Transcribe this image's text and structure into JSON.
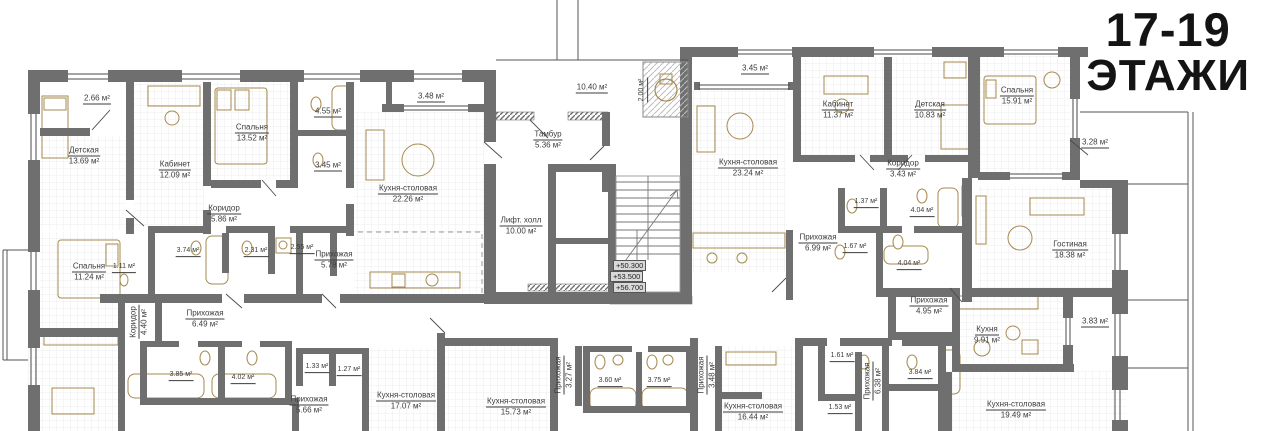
{
  "title": {
    "line1": "17-19",
    "line2": "ЭТАЖИ"
  },
  "colors": {
    "walls": "#6f6f6f",
    "furniture": "#a58a4f",
    "text": "#3c3c3c",
    "title": "#141414"
  },
  "stair_elevations": [
    "+50.300",
    "+53.500",
    "+56.700"
  ],
  "rooms": [
    {
      "name": "",
      "area": "2.66 м²",
      "x": 97,
      "y": 99
    },
    {
      "name": "Детская",
      "area": "13.69 м²",
      "x": 84,
      "y": 156
    },
    {
      "name": "Кабинет",
      "area": "12.09 м²",
      "x": 175,
      "y": 170
    },
    {
      "name": "Спальня",
      "area": "13.52 м²",
      "x": 252,
      "y": 133
    },
    {
      "name": "",
      "area": "4.55 м²",
      "x": 328,
      "y": 112
    },
    {
      "name": "",
      "area": "3.45 м²",
      "x": 328,
      "y": 166
    },
    {
      "name": "",
      "area": "3.48 м²",
      "x": 431,
      "y": 97
    },
    {
      "name": "Кухня-столовая",
      "area": "22.26 м²",
      "x": 408,
      "y": 194
    },
    {
      "name": "Коридор",
      "area": "5.86 м²",
      "x": 224,
      "y": 214
    },
    {
      "name": "",
      "area": "3.74 м²",
      "x": 188,
      "y": 252,
      "small": true
    },
    {
      "name": "",
      "area": "2.31 м²",
      "x": 256,
      "y": 252,
      "small": true
    },
    {
      "name": "",
      "area": "2.55 м²",
      "x": 302,
      "y": 249,
      "small": true
    },
    {
      "name": "Прихожая",
      "area": "5.78 м²",
      "x": 334,
      "y": 260
    },
    {
      "name": "Спальня",
      "area": "11.24 м²",
      "x": 89,
      "y": 272
    },
    {
      "name": "",
      "area": "1.11 м²",
      "x": 124,
      "y": 268,
      "small": true
    },
    {
      "name": "Коридор",
      "area": "4.40 м²",
      "x": 139,
      "y": 322,
      "rot": true
    },
    {
      "name": "Прихожая",
      "area": "6.49 м²",
      "x": 205,
      "y": 319
    },
    {
      "name": "",
      "area": "3.85 м²",
      "x": 181,
      "y": 376,
      "small": true
    },
    {
      "name": "",
      "area": "4.02 м²",
      "x": 243,
      "y": 379,
      "small": true
    },
    {
      "name": "Прихожая",
      "area": "5.66 м²",
      "x": 309,
      "y": 405
    },
    {
      "name": "",
      "area": "1.33 м²",
      "x": 317,
      "y": 368,
      "small": true
    },
    {
      "name": "",
      "area": "1.27 м²",
      "x": 349,
      "y": 371,
      "small": true
    },
    {
      "name": "Кухня-столовая",
      "area": "17.07 м²",
      "x": 406,
      "y": 401
    },
    {
      "name": "Кухня-столовая",
      "area": "15.73 м²",
      "x": 516,
      "y": 407
    },
    {
      "name": "Прихожая",
      "area": "3.27 м²",
      "x": 564,
      "y": 375,
      "rot": true
    },
    {
      "name": "",
      "area": "3.60 м²",
      "x": 610,
      "y": 382,
      "small": true
    },
    {
      "name": "",
      "area": "3.75 м²",
      "x": 659,
      "y": 382,
      "small": true
    },
    {
      "name": "Прихожая",
      "area": "3.48 м²",
      "x": 707,
      "y": 375,
      "rot": true
    },
    {
      "name": "Кухня-столовая",
      "area": "16.44 м²",
      "x": 753,
      "y": 412
    },
    {
      "name": "",
      "area": "10.40 м²",
      "x": 592,
      "y": 88
    },
    {
      "name": "",
      "area": "2.00 м²",
      "x": 643,
      "y": 90,
      "rot": true,
      "small": true
    },
    {
      "name": "Тамбур",
      "area": "5.36 м²",
      "x": 548,
      "y": 140
    },
    {
      "name": "Лифт. холл",
      "area": "10.00 м²",
      "x": 521,
      "y": 226
    },
    {
      "name": "",
      "area": "3.45 м²",
      "x": 755,
      "y": 69
    },
    {
      "name": "Кухня-столовая",
      "area": "23.24 м²",
      "x": 748,
      "y": 168
    },
    {
      "name": "Кабинет",
      "area": "11.37 м²",
      "x": 838,
      "y": 110
    },
    {
      "name": "Детская",
      "area": "10.83 м²",
      "x": 930,
      "y": 110
    },
    {
      "name": "Коридор",
      "area": "3.43 м²",
      "x": 903,
      "y": 169
    },
    {
      "name": "",
      "area": "1.37 м²",
      "x": 866,
      "y": 203,
      "small": true
    },
    {
      "name": "",
      "area": "4.04 м²",
      "x": 922,
      "y": 212,
      "small": true
    },
    {
      "name": "Прихожая",
      "area": "6.99 м²",
      "x": 818,
      "y": 243
    },
    {
      "name": "",
      "area": "1.67 м²",
      "x": 855,
      "y": 248,
      "small": true
    },
    {
      "name": "",
      "area": "4.04 м²",
      "x": 909,
      "y": 265,
      "small": true
    },
    {
      "name": "Спальня",
      "area": "15.91 м²",
      "x": 1017,
      "y": 96
    },
    {
      "name": "",
      "area": "3.28 м²",
      "x": 1095,
      "y": 143
    },
    {
      "name": "Гостиная",
      "area": "18.38 м²",
      "x": 1070,
      "y": 250
    },
    {
      "name": "Прихожая",
      "area": "4.95 м²",
      "x": 929,
      "y": 306
    },
    {
      "name": "Кухня",
      "area": "9.91 м²",
      "x": 987,
      "y": 335
    },
    {
      "name": "",
      "area": "3.83 м²",
      "x": 1095,
      "y": 322
    },
    {
      "name": "",
      "area": "1.61 м²",
      "x": 842,
      "y": 357,
      "small": true
    },
    {
      "name": "",
      "area": "1.53 м²",
      "x": 840,
      "y": 409,
      "small": true
    },
    {
      "name": "Прихожая",
      "area": "6.38 м²",
      "x": 873,
      "y": 381,
      "rot": true
    },
    {
      "name": "",
      "area": "3.84 м²",
      "x": 920,
      "y": 374,
      "small": true
    },
    {
      "name": "Кухня-столовая",
      "area": "19.49 м²",
      "x": 1016,
      "y": 410
    }
  ]
}
